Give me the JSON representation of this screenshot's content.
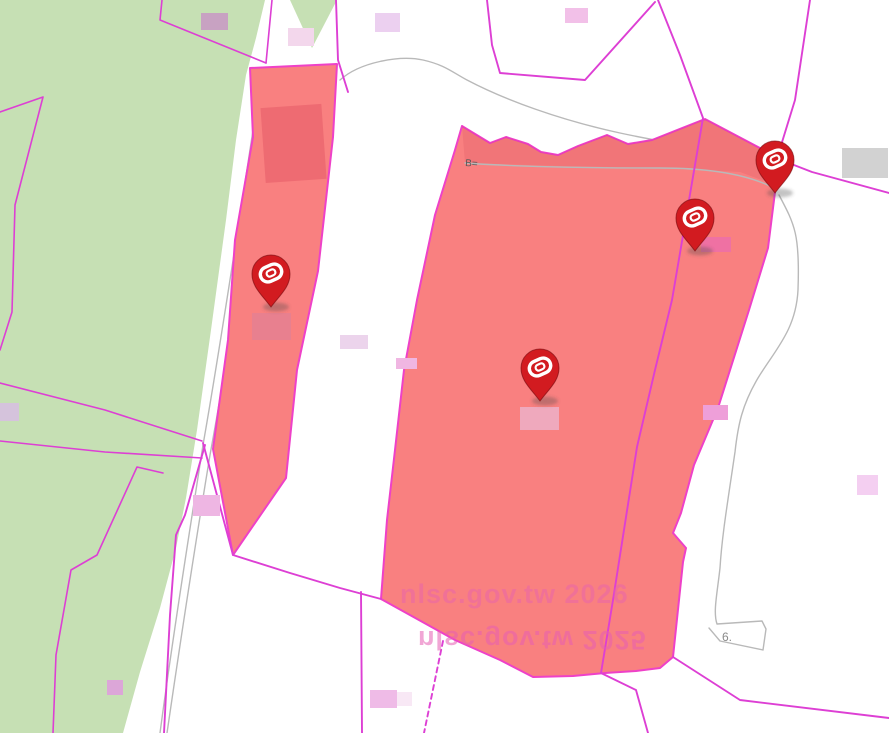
{
  "map": {
    "watermark_line1": "nlsc.gov.tw 2026",
    "watermark_line2_mirrored": "nlsc.gov.tw 2025",
    "road_label_top": "B=",
    "road_label_bottom": "6."
  },
  "markers": [
    {
      "name": "pin-left-strip"
    },
    {
      "name": "pin-main-center"
    },
    {
      "name": "pin-main-upper-right"
    },
    {
      "name": "pin-main-top-right"
    }
  ],
  "colors": {
    "background": "#ffffff",
    "farmland_green": "#c6e0b4",
    "parcel_line_magenta": "#dd3fd4",
    "highlight_edge_magenta": "#ee41c8",
    "highlight_red_fill": "#f98080",
    "highlight_red_dark": "#ee6b72",
    "road_gray": "#b9b9b9",
    "marker_red": "#d21b20",
    "watermark_pink": "#e75fb3",
    "label_gray_box": "#d2d2d2"
  },
  "boxes": [
    {
      "color": "#c8a2c2"
    },
    {
      "color": "#f3d7ec"
    },
    {
      "color": "#ecd0f0"
    },
    {
      "color": "#f2c0e8"
    },
    {
      "color": "#d2d2d2"
    },
    {
      "color": "#ecd4ec"
    },
    {
      "color": "#f0b6e2"
    },
    {
      "color": "#d5c3dc"
    },
    {
      "color": "#eeb6e3"
    },
    {
      "color": "#dca6d8"
    },
    {
      "color": "#efbbe7"
    },
    {
      "color": "#f8e8f5"
    },
    {
      "color": "#ee9fd9"
    },
    {
      "color": "#f4cff1"
    },
    {
      "color": "#e8808f"
    },
    {
      "color": "#efa9bd"
    },
    {
      "color": "#ef71a3"
    }
  ]
}
